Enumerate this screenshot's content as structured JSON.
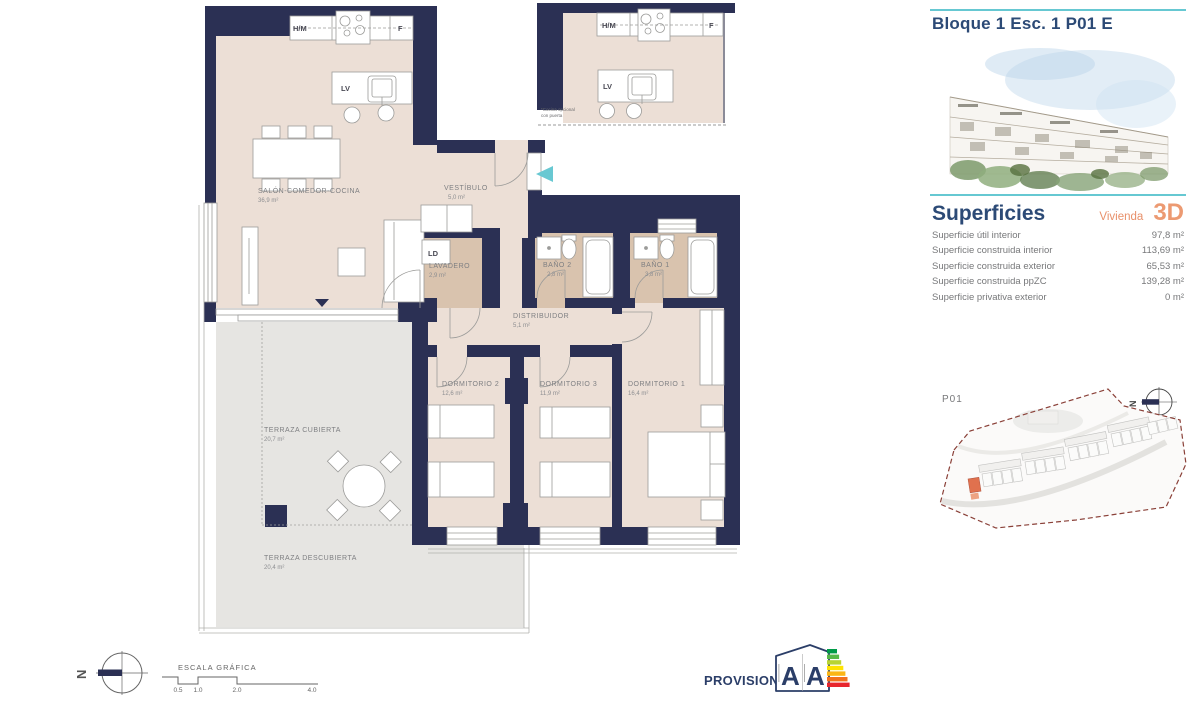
{
  "sidebar": {
    "title": "Bloque 1 Esc. 1 P01 E",
    "superficies_heading": "Superficies",
    "vivienda_label": "Vivienda",
    "vivienda_code": "3D",
    "surface_rows": [
      {
        "label": "Superficie útil interior",
        "value": "97,8 m²"
      },
      {
        "label": "Superficie construida interior",
        "value": "113,69 m²"
      },
      {
        "label": "Superficie construida exterior",
        "value": "65,53 m²"
      },
      {
        "label": "Superficie construida ppZC",
        "value": "139,28 m²"
      },
      {
        "label": "Superficie privativa exterior",
        "value": "0 m²"
      }
    ],
    "siteplan_label": "P01",
    "north_letter": "N"
  },
  "plan": {
    "north_letter": "N",
    "rooms": [
      {
        "name": "SALÓN-COMEDOR-COCINA",
        "area": "36,9 m²"
      },
      {
        "name": "VESTÍBULO",
        "area": "5,0 m²"
      },
      {
        "name": "LAVADERO",
        "area": "2,9 m²"
      },
      {
        "name": "BAÑO 2",
        "area": "2,8 m²"
      },
      {
        "name": "BAÑO 1",
        "area": "3,8 m²"
      },
      {
        "name": "DISTRIBUIDOR",
        "area": "5,1 m²"
      },
      {
        "name": "DORMITORIO 2",
        "area": "12,6 m²"
      },
      {
        "name": "DORMITORIO 3",
        "area": "11,9 m²"
      },
      {
        "name": "DORMITORIO 1",
        "area": "16,4 m²"
      },
      {
        "name": "TERRAZA CUBIERTA",
        "area": "20,7 m²"
      },
      {
        "name": "TERRAZA DESCUBIERTA",
        "area": "20,4 m²"
      }
    ],
    "fixtures": {
      "hm": "H/M",
      "f": "F",
      "lv": "LV",
      "ld": "LD"
    },
    "inset": {
      "hm": "H/M",
      "f": "F",
      "lv": "LV",
      "note_line1": "*Cocina opcional",
      "note_line2": "con puerta"
    }
  },
  "footer": {
    "scale_label": "ESCALA GRÁFICA",
    "scale_ticks": [
      "0.5",
      "1.0",
      "2.0",
      "4.0"
    ],
    "provisional_label": "PROVISIONAL",
    "energy_letter_left": "A",
    "energy_letter_right": "A",
    "north_letter": "N"
  },
  "colors": {
    "wall_navy": "#2b3054",
    "accent_teal": "#66c8d2",
    "accent_orange": "#e98e6b",
    "heading_blue": "#2c4a76",
    "floor_beige": "#ecdfd6",
    "wet_tan": "#d9c3ae",
    "terrace_grey": "#e6e5e2",
    "siteplan_boundary": "#8a4038",
    "energy_bar_colors": [
      "#009b48",
      "#55b948",
      "#b8d432",
      "#ffe300",
      "#fbb615",
      "#f2711c",
      "#e8262d"
    ]
  }
}
